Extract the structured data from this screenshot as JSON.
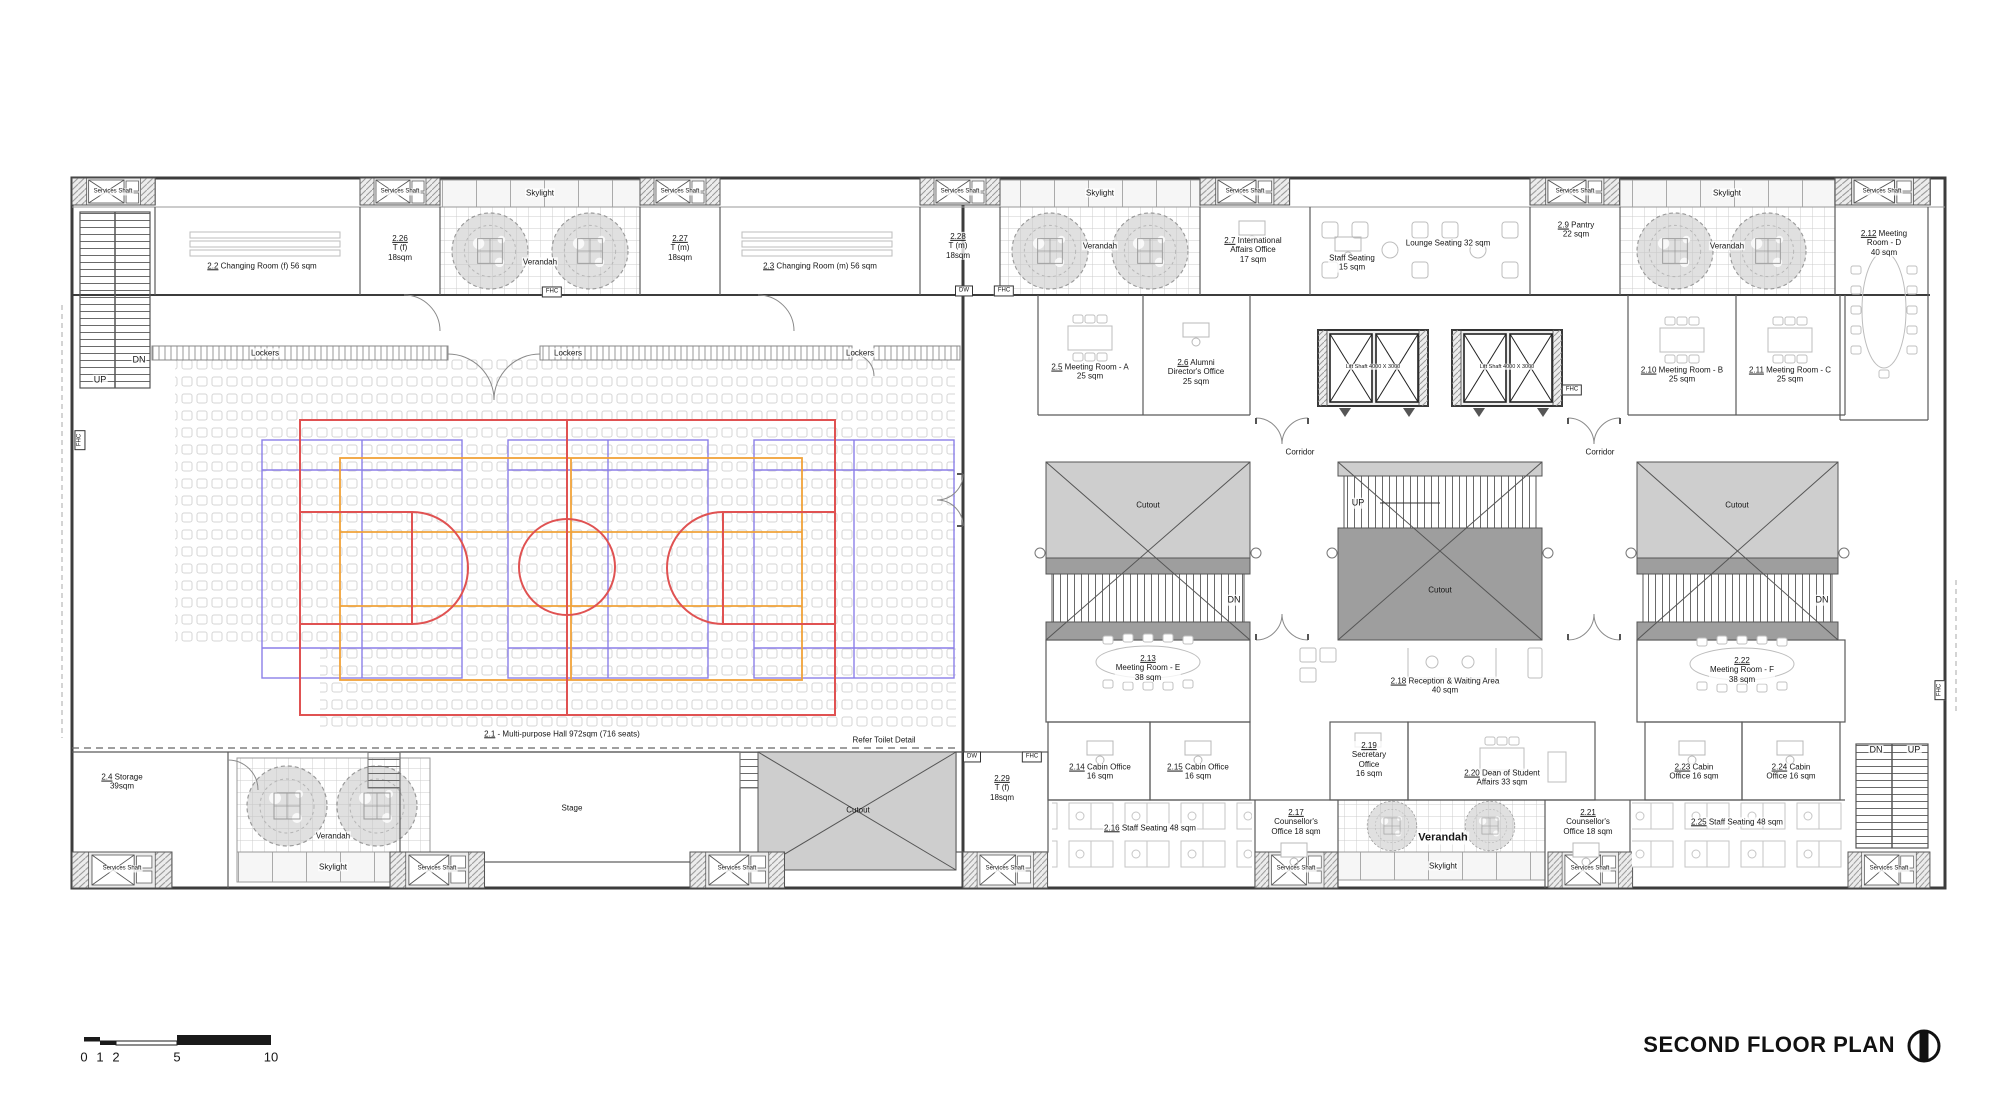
{
  "title": {
    "text": "SECOND FLOOR PLAN"
  },
  "compass_icon": "north-section-marker",
  "colors": {
    "court_red": "#e05252",
    "court_purple": "#8b7fe8",
    "court_orange": "#f0a238",
    "cutout_light": "#cecece",
    "cutout_dark": "#9e9e9e"
  },
  "scalebar": {
    "unit_labels": [
      "0",
      "1",
      "2",
      "5",
      "10"
    ]
  },
  "labels": [
    {
      "id": "services-shaft-top-1",
      "x": 113,
      "y": 192,
      "fs": 6,
      "lines": [
        {
          "t": "Services Shaft"
        }
      ]
    },
    {
      "id": "services-shaft-top-2",
      "x": 400,
      "y": 192,
      "fs": 6,
      "lines": [
        {
          "t": "Services Shaft"
        }
      ]
    },
    {
      "id": "services-shaft-top-3",
      "x": 680,
      "y": 192,
      "fs": 6,
      "lines": [
        {
          "t": "Services Shaft"
        }
      ]
    },
    {
      "id": "services-shaft-top-4",
      "x": 960,
      "y": 192,
      "fs": 6,
      "lines": [
        {
          "t": "Services Shaft"
        }
      ]
    },
    {
      "id": "services-shaft-top-5",
      "x": 1245,
      "y": 192,
      "fs": 6,
      "lines": [
        {
          "t": "Services Shaft"
        }
      ]
    },
    {
      "id": "services-shaft-top-6",
      "x": 1575,
      "y": 192,
      "fs": 6,
      "lines": [
        {
          "t": "Services Shaft"
        }
      ]
    },
    {
      "id": "services-shaft-top-7",
      "x": 1882,
      "y": 192,
      "fs": 6,
      "lines": [
        {
          "t": "Services Shaft"
        }
      ]
    },
    {
      "id": "services-shaft-bot-1",
      "x": 122,
      "y": 869,
      "fs": 6,
      "lines": [
        {
          "t": "Services Shaft"
        }
      ]
    },
    {
      "id": "services-shaft-bot-2",
      "x": 437,
      "y": 869,
      "fs": 6,
      "lines": [
        {
          "t": "Services Shaft"
        }
      ]
    },
    {
      "id": "services-shaft-bot-3",
      "x": 737,
      "y": 869,
      "fs": 6,
      "lines": [
        {
          "t": "Services Shaft"
        }
      ]
    },
    {
      "id": "services-shaft-bot-4",
      "x": 1005,
      "y": 869,
      "fs": 6,
      "lines": [
        {
          "t": "Services Shaft"
        }
      ]
    },
    {
      "id": "services-shaft-bot-5",
      "x": 1296,
      "y": 869,
      "fs": 6,
      "lines": [
        {
          "t": "Services Shaft"
        }
      ]
    },
    {
      "id": "services-shaft-bot-6",
      "x": 1590,
      "y": 869,
      "fs": 6,
      "lines": [
        {
          "t": "Services Shaft"
        }
      ]
    },
    {
      "id": "services-shaft-bot-7",
      "x": 1889,
      "y": 869,
      "fs": 6,
      "lines": [
        {
          "t": "Services Shaft"
        }
      ]
    },
    {
      "id": "room-2-2",
      "x": 262,
      "y": 266,
      "lines": [
        {
          "u": "2.2",
          "t": " Changing Room (f) 56 sqm"
        }
      ]
    },
    {
      "id": "room-2-26",
      "x": 400,
      "y": 248,
      "lines": [
        {
          "u": "2.26"
        },
        {
          "t": "T (f)"
        },
        {
          "t": "18sqm"
        }
      ]
    },
    {
      "id": "skylight-1",
      "x": 540,
      "y": 193,
      "lines": [
        {
          "t": "Skylight"
        }
      ]
    },
    {
      "id": "verandah-1",
      "x": 540,
      "y": 262,
      "lines": [
        {
          "t": "Verandah"
        }
      ]
    },
    {
      "id": "room-2-27",
      "x": 680,
      "y": 248,
      "lines": [
        {
          "u": "2.27"
        },
        {
          "t": "T (m)"
        },
        {
          "t": "18sqm"
        }
      ]
    },
    {
      "id": "room-2-3",
      "x": 820,
      "y": 266,
      "lines": [
        {
          "u": "2.3",
          "t": " Changing Room (m) 56 sqm"
        }
      ]
    },
    {
      "id": "room-2-28",
      "x": 958,
      "y": 246,
      "lines": [
        {
          "u": "2.28"
        },
        {
          "t": "T (m)"
        },
        {
          "t": "18sqm"
        }
      ]
    },
    {
      "id": "skylight-2",
      "x": 1100,
      "y": 193,
      "lines": [
        {
          "t": "Skylight"
        }
      ]
    },
    {
      "id": "verandah-2",
      "x": 1100,
      "y": 246,
      "lines": [
        {
          "t": "Verandah"
        }
      ]
    },
    {
      "id": "room-2-7",
      "x": 1253,
      "y": 250,
      "lines": [
        {
          "u": "2.7",
          "t": " International"
        },
        {
          "t": "Affairs Office"
        },
        {
          "t": "17 sqm"
        }
      ]
    },
    {
      "id": "staff-seating-15",
      "x": 1352,
      "y": 263,
      "lines": [
        {
          "t": "Staff Seating"
        },
        {
          "t": "15 sqm"
        }
      ]
    },
    {
      "id": "lounge-seating",
      "x": 1448,
      "y": 243,
      "lines": [
        {
          "t": "Lounge Seating 32 sqm"
        }
      ]
    },
    {
      "id": "room-2-9",
      "x": 1576,
      "y": 230,
      "lines": [
        {
          "u": "2.9",
          "t": " Pantry"
        },
        {
          "t": "22 sqm"
        }
      ]
    },
    {
      "id": "skylight-3",
      "x": 1727,
      "y": 193,
      "lines": [
        {
          "t": "Skylight"
        }
      ]
    },
    {
      "id": "verandah-3",
      "x": 1727,
      "y": 246,
      "lines": [
        {
          "t": "Verandah"
        }
      ]
    },
    {
      "id": "room-2-12",
      "x": 1884,
      "y": 243,
      "lines": [
        {
          "u": "2.12",
          "t": " Meeting"
        },
        {
          "t": "Room - D"
        },
        {
          "t": "40 sqm"
        }
      ]
    },
    {
      "id": "lockers-1",
      "x": 265,
      "y": 353,
      "lines": [
        {
          "t": "Lockers"
        }
      ]
    },
    {
      "id": "lockers-2",
      "x": 568,
      "y": 353,
      "lines": [
        {
          "t": "Lockers"
        }
      ]
    },
    {
      "id": "lockers-3",
      "x": 860,
      "y": 353,
      "lines": [
        {
          "t": "Lockers"
        }
      ]
    },
    {
      "id": "room-2-5",
      "x": 1090,
      "y": 372,
      "lines": [
        {
          "u": "2.5",
          "t": " Meeting Room - A"
        },
        {
          "t": "25 sqm"
        }
      ]
    },
    {
      "id": "room-2-6",
      "x": 1196,
      "y": 372,
      "lines": [
        {
          "u": "2.6",
          "t": " Alumni"
        },
        {
          "t": "Director's Office"
        },
        {
          "t": "25 sqm"
        }
      ]
    },
    {
      "id": "lift-shaft-1",
      "x": 1373,
      "y": 367,
      "fs": 5.5,
      "lines": [
        {
          "t": "Lift Shaft 4000 X 3000"
        }
      ]
    },
    {
      "id": "lift-shaft-2",
      "x": 1507,
      "y": 367,
      "fs": 5.5,
      "lines": [
        {
          "t": "Lift Shaft 4000 X 3000"
        }
      ]
    },
    {
      "id": "room-2-10",
      "x": 1682,
      "y": 375,
      "lines": [
        {
          "u": "2.10",
          "t": " Meeting Room - B"
        },
        {
          "t": "25 sqm"
        }
      ]
    },
    {
      "id": "room-2-11",
      "x": 1790,
      "y": 375,
      "lines": [
        {
          "u": "2.11",
          "t": " Meeting Room - C"
        },
        {
          "t": "25 sqm"
        }
      ]
    },
    {
      "id": "corridor-1",
      "x": 1300,
      "y": 452,
      "lines": [
        {
          "t": "Corridor"
        }
      ]
    },
    {
      "id": "corridor-2",
      "x": 1600,
      "y": 452,
      "lines": [
        {
          "t": "Corridor"
        }
      ]
    },
    {
      "id": "cutout-atrium-left",
      "x": 1148,
      "y": 505,
      "nobg": true,
      "lines": [
        {
          "t": "Cutout"
        }
      ]
    },
    {
      "id": "cutout-atrium-mid",
      "x": 1440,
      "y": 590,
      "nobg": true,
      "lines": [
        {
          "t": "Cutout"
        }
      ]
    },
    {
      "id": "cutout-atrium-right",
      "x": 1737,
      "y": 505,
      "nobg": true,
      "lines": [
        {
          "t": "Cutout"
        }
      ]
    },
    {
      "id": "up-mid-stair",
      "x": 1358,
      "y": 503,
      "fs": 9,
      "lines": [
        {
          "t": "UP"
        }
      ]
    },
    {
      "id": "dn-atrium-left",
      "x": 1234,
      "y": 600,
      "fs": 9,
      "lines": [
        {
          "t": "DN"
        }
      ]
    },
    {
      "id": "dn-atrium-right",
      "x": 1822,
      "y": 600,
      "fs": 9,
      "lines": [
        {
          "t": "DN"
        }
      ]
    },
    {
      "id": "up-left-stair",
      "x": 100,
      "y": 380,
      "fs": 9,
      "lines": [
        {
          "t": "UP"
        }
      ]
    },
    {
      "id": "dn-left-stair",
      "x": 139,
      "y": 360,
      "fs": 9,
      "lines": [
        {
          "t": "DN"
        }
      ]
    },
    {
      "id": "hall-label",
      "x": 562,
      "y": 734,
      "lines": [
        {
          "u": "2.1",
          "t": " - Multi-purpose Hall 972sqm (716 seats)"
        }
      ]
    },
    {
      "id": "refer-toilet-detail",
      "x": 884,
      "y": 740,
      "lines": [
        {
          "t": "Refer Toilet Detail"
        }
      ]
    },
    {
      "id": "room-2-4",
      "x": 122,
      "y": 782,
      "lines": [
        {
          "u": "2.4",
          "t": " Storage"
        },
        {
          "t": "39sqm"
        }
      ]
    },
    {
      "id": "verandah-4",
      "x": 333,
      "y": 836,
      "lines": [
        {
          "t": "Verandah"
        }
      ]
    },
    {
      "id": "skylight-4",
      "x": 333,
      "y": 867,
      "lines": [
        {
          "t": "Skylight"
        }
      ]
    },
    {
      "id": "stage",
      "x": 572,
      "y": 808,
      "lines": [
        {
          "t": "Stage"
        }
      ]
    },
    {
      "id": "cutout-bottom",
      "x": 858,
      "y": 810,
      "nobg": true,
      "lines": [
        {
          "t": "Cutout"
        }
      ]
    },
    {
      "id": "room-2-29",
      "x": 1002,
      "y": 788,
      "lines": [
        {
          "u": "2.29"
        },
        {
          "t": "T (f)"
        },
        {
          "t": "18sqm"
        }
      ]
    },
    {
      "id": "dw-1",
      "x": 964,
      "y": 291,
      "fs": 6,
      "box": true,
      "lines": [
        {
          "t": "DW"
        }
      ]
    },
    {
      "id": "fhc-1",
      "x": 552,
      "y": 292,
      "fs": 6,
      "box": true,
      "lines": [
        {
          "t": "FHC"
        }
      ]
    },
    {
      "id": "fhc-2",
      "x": 1004,
      "y": 291,
      "fs": 6,
      "box": true,
      "lines": [
        {
          "t": "FHC"
        }
      ]
    },
    {
      "id": "dw-2",
      "x": 972,
      "y": 757,
      "fs": 6,
      "box": true,
      "lines": [
        {
          "t": "DW"
        }
      ]
    },
    {
      "id": "fhc-3",
      "x": 1032,
      "y": 757,
      "fs": 6,
      "box": true,
      "lines": [
        {
          "t": "FHC"
        }
      ]
    },
    {
      "id": "fhc-4",
      "x": 1572,
      "y": 390,
      "fs": 6,
      "box": true,
      "lines": [
        {
          "t": "FHC"
        }
      ]
    },
    {
      "id": "fhc-left-edge",
      "x": 80,
      "y": 440,
      "fs": 6,
      "box": true,
      "rot": -90,
      "lines": [
        {
          "t": "FHC"
        }
      ]
    },
    {
      "id": "fhc-right-edge",
      "x": 1940,
      "y": 690,
      "fs": 6,
      "box": true,
      "rot": -90,
      "lines": [
        {
          "t": "FHC"
        }
      ]
    },
    {
      "id": "room-2-13",
      "x": 1148,
      "y": 668,
      "lines": [
        {
          "u": "2.13"
        },
        {
          "t": "Meeting Room - E"
        },
        {
          "t": "38 sqm"
        }
      ]
    },
    {
      "id": "room-2-18",
      "x": 1445,
      "y": 686,
      "lines": [
        {
          "u": "2.18",
          "t": " Reception & Waiting Area"
        },
        {
          "t": "40 sqm"
        }
      ]
    },
    {
      "id": "room-2-22",
      "x": 1742,
      "y": 670,
      "lines": [
        {
          "u": "2.22"
        },
        {
          "t": "Meeting Room - F"
        },
        {
          "t": "38 sqm"
        }
      ]
    },
    {
      "id": "room-2-14",
      "x": 1100,
      "y": 772,
      "lines": [
        {
          "u": "2.14",
          "t": " Cabin Office"
        },
        {
          "t": "16 sqm"
        }
      ]
    },
    {
      "id": "room-2-15",
      "x": 1198,
      "y": 772,
      "lines": [
        {
          "u": "2.15",
          "t": " Cabin Office"
        },
        {
          "t": "16 sqm"
        }
      ]
    },
    {
      "id": "room-2-19",
      "x": 1369,
      "y": 760,
      "lines": [
        {
          "u": "2.19"
        },
        {
          "t": "Secretary"
        },
        {
          "t": "Office"
        },
        {
          "t": "16 sqm"
        }
      ]
    },
    {
      "id": "room-2-20",
      "x": 1502,
      "y": 778,
      "lines": [
        {
          "u": "2.20",
          "t": " Dean of Student"
        },
        {
          "t": "Affairs 33 sqm"
        }
      ]
    },
    {
      "id": "room-2-23",
      "x": 1694,
      "y": 772,
      "lines": [
        {
          "u": "2.23",
          "t": " Cabin"
        },
        {
          "t": "Office 16 sqm"
        }
      ]
    },
    {
      "id": "room-2-24",
      "x": 1791,
      "y": 772,
      "lines": [
        {
          "u": "2.24",
          "t": " Cabin"
        },
        {
          "t": "Office 16 sqm"
        }
      ]
    },
    {
      "id": "room-2-16",
      "x": 1150,
      "y": 828,
      "lines": [
        {
          "u": "2.16",
          "t": " Staff Seating 48 sqm"
        }
      ]
    },
    {
      "id": "room-2-17",
      "x": 1296,
      "y": 822,
      "lines": [
        {
          "u": "2.17"
        },
        {
          "t": "Counsellor's"
        },
        {
          "t": "Office 18 sqm"
        }
      ]
    },
    {
      "id": "verandah-5",
      "x": 1443,
      "y": 838,
      "fs": 11,
      "bold": true,
      "lines": [
        {
          "t": "Verandah"
        }
      ]
    },
    {
      "id": "skylight-5",
      "x": 1443,
      "y": 866,
      "lines": [
        {
          "t": "Skylight"
        }
      ]
    },
    {
      "id": "room-2-21",
      "x": 1588,
      "y": 822,
      "lines": [
        {
          "u": "2.21"
        },
        {
          "t": "Counsellor's"
        },
        {
          "t": "Office 18 sqm"
        }
      ]
    },
    {
      "id": "room-2-25",
      "x": 1737,
      "y": 822,
      "lines": [
        {
          "u": "2.25",
          "t": " Staff Seating 48 sqm"
        }
      ]
    },
    {
      "id": "dn-right-stair",
      "x": 1876,
      "y": 750,
      "fs": 9,
      "lines": [
        {
          "t": "DN"
        }
      ]
    },
    {
      "id": "up-right-stair",
      "x": 1914,
      "y": 750,
      "fs": 9,
      "lines": [
        {
          "t": "UP"
        }
      ]
    },
    {
      "id": "scale-0",
      "x": 84,
      "y": 1057,
      "fs": 13,
      "lines": [
        {
          "t": "0"
        }
      ]
    },
    {
      "id": "scale-1",
      "x": 100,
      "y": 1057,
      "fs": 13,
      "lines": [
        {
          "t": "1"
        }
      ]
    },
    {
      "id": "scale-2",
      "x": 116,
      "y": 1057,
      "fs": 13,
      "lines": [
        {
          "t": "2"
        }
      ]
    },
    {
      "id": "scale-5",
      "x": 177,
      "y": 1057,
      "fs": 13,
      "lines": [
        {
          "t": "5"
        }
      ]
    },
    {
      "id": "scale-10",
      "x": 271,
      "y": 1057,
      "fs": 13,
      "lines": [
        {
          "t": "10"
        }
      ]
    }
  ]
}
